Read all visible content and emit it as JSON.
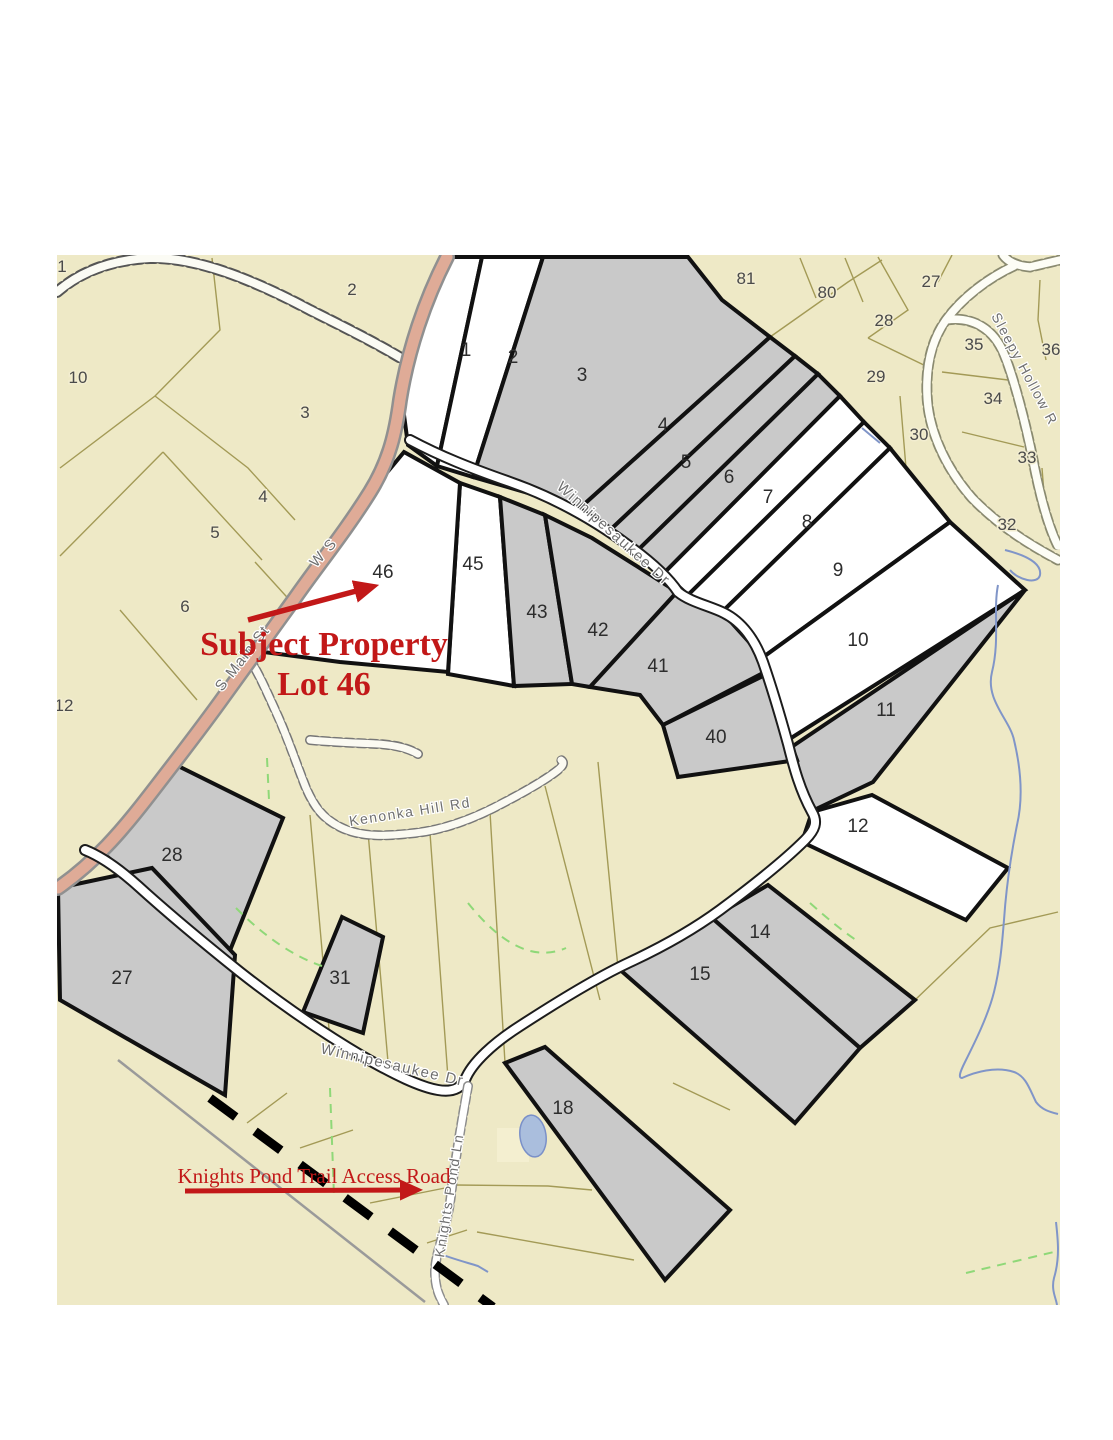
{
  "annotations": {
    "subject_property_line1": "Subject Property",
    "subject_property_line2": "Lot 46",
    "trail_access_label": "Knights Pond Trail Access Road"
  },
  "roads": {
    "s_main_st": "S Main St",
    "s_main_st_extra": "W S",
    "winnipesaukee_dr_upper": "Winnipesaukee Dr",
    "winnipesaukee_dr_lower": "Winnipesaukee Dr",
    "kenonka_hill_rd": "Kenonka Hill Rd",
    "sleepy_hollow_rd": "Sleepy Hollow R",
    "knights_pond_ln": "Knights Pond Ln"
  },
  "subdivision_lots": {
    "l1": "1",
    "l2": "2",
    "l3": "3",
    "l4": "4",
    "l5": "5",
    "l6": "6",
    "l7": "7",
    "l8": "8",
    "l9": "9",
    "l10": "10",
    "l11": "11",
    "l12": "12",
    "l14": "14",
    "l15": "15",
    "l18": "18",
    "l27": "27",
    "l28": "28",
    "l31": "31",
    "l40": "40",
    "l41": "41",
    "l42": "42",
    "l43": "43",
    "l45": "45",
    "l46": "46"
  },
  "background_lots": {
    "b1": "1",
    "b2": "2",
    "b3": "3",
    "b4": "4",
    "b5": "5",
    "b6": "6",
    "b10": "10",
    "b12": "12",
    "b27": "27",
    "b28": "28",
    "b29": "29",
    "b30": "30",
    "b32": "32",
    "b33": "33",
    "b34": "34",
    "b35": "35",
    "b36": "36",
    "b80": "80",
    "b81": "81"
  },
  "colors": {
    "map_background": "#eee9c6",
    "parcel_gray": "#c9c9c9",
    "parcel_white": "#ffffff",
    "boundary_black": "#111111",
    "background_line_olive": "#a39a56",
    "main_street_salmon": "#dfab97",
    "stream_blue": "#8095c8",
    "vegetation_green": "#8fd878",
    "annotation_red": "#c21818"
  }
}
